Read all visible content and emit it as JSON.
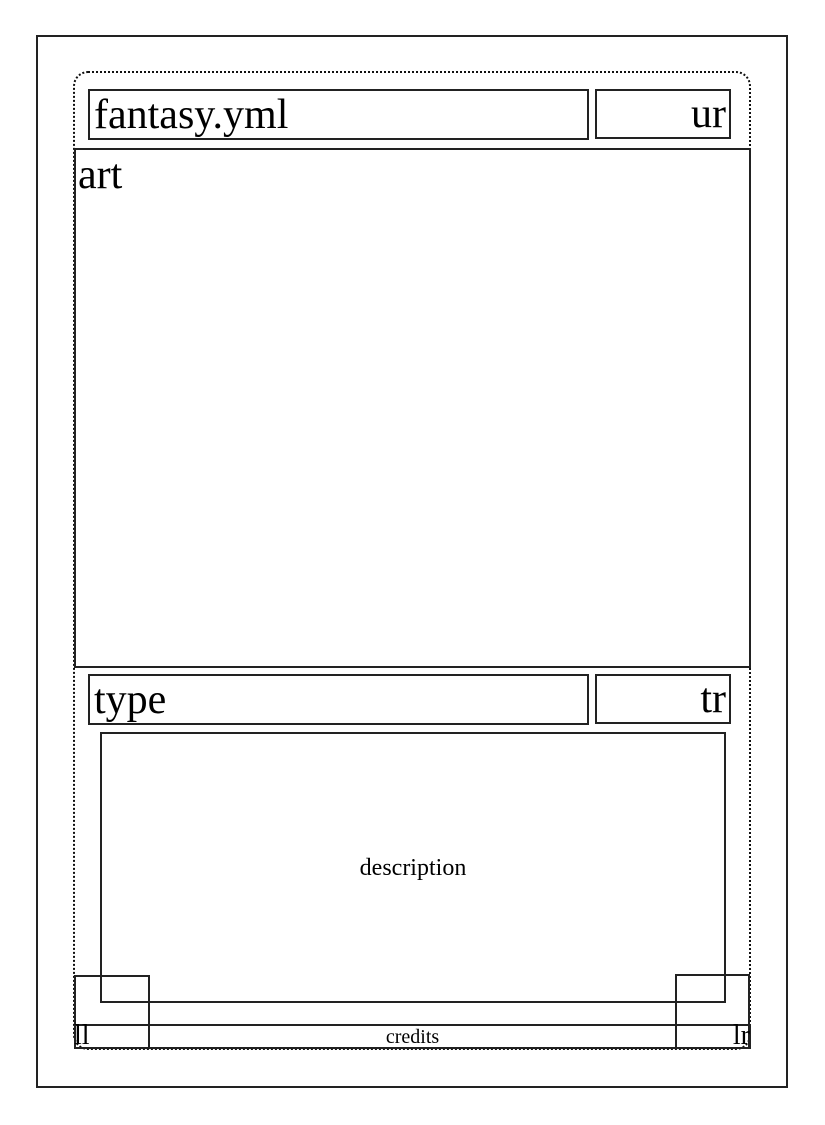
{
  "layout_proof": {
    "title": "fantasy.yml",
    "upper_right": "ur",
    "art": "art",
    "type": "type",
    "type_right": "tr",
    "description": "description",
    "lower_left": "ll",
    "credits": "credits",
    "lower_right": "lr"
  },
  "colors": {
    "line": "#222222",
    "cut_line": "#111111",
    "text": "#000000",
    "background": "#ffffff"
  }
}
